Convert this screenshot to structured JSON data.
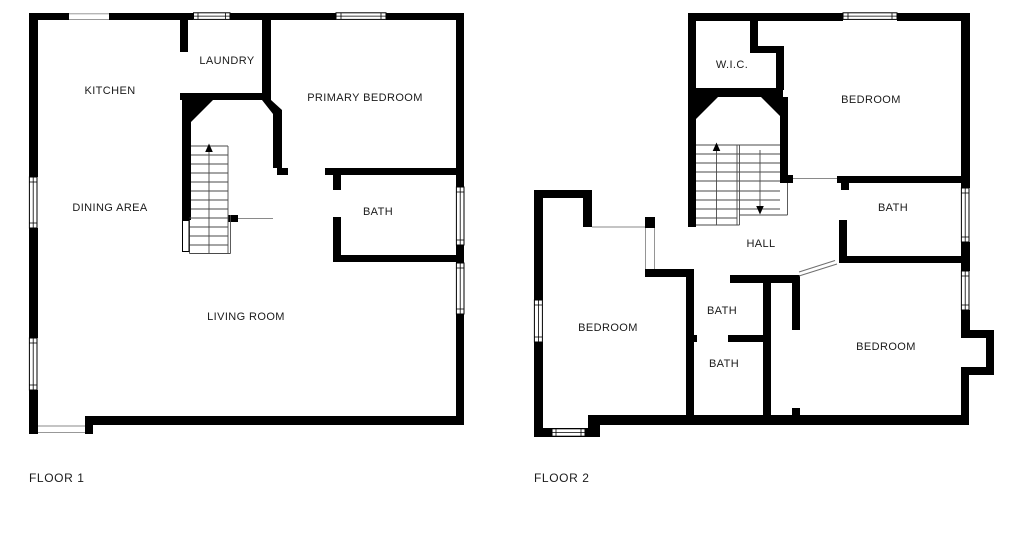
{
  "colors": {
    "wall": "#000000",
    "background": "#ffffff",
    "thin_line": "#8a8a8a",
    "stair_line": "#4a4a4a",
    "text": "#1a1a1a"
  },
  "floor1": {
    "title": "FLOOR 1",
    "rooms": {
      "kitchen": "KITCHEN",
      "laundry": "LAUNDRY",
      "primary_bedroom": "PRIMARY BEDROOM",
      "dining_area": "DINING AREA",
      "bath": "BATH",
      "living_room": "LIVING ROOM"
    }
  },
  "floor2": {
    "title": "FLOOR 2",
    "rooms": {
      "wic": "W.I.C.",
      "bedroom_top_right": "BEDROOM",
      "bath_right": "BATH",
      "hall": "HALL",
      "bedroom_left": "BEDROOM",
      "bath_upper": "BATH",
      "bath_lower": "BATH",
      "bedroom_bottom_right": "BEDROOM"
    }
  }
}
